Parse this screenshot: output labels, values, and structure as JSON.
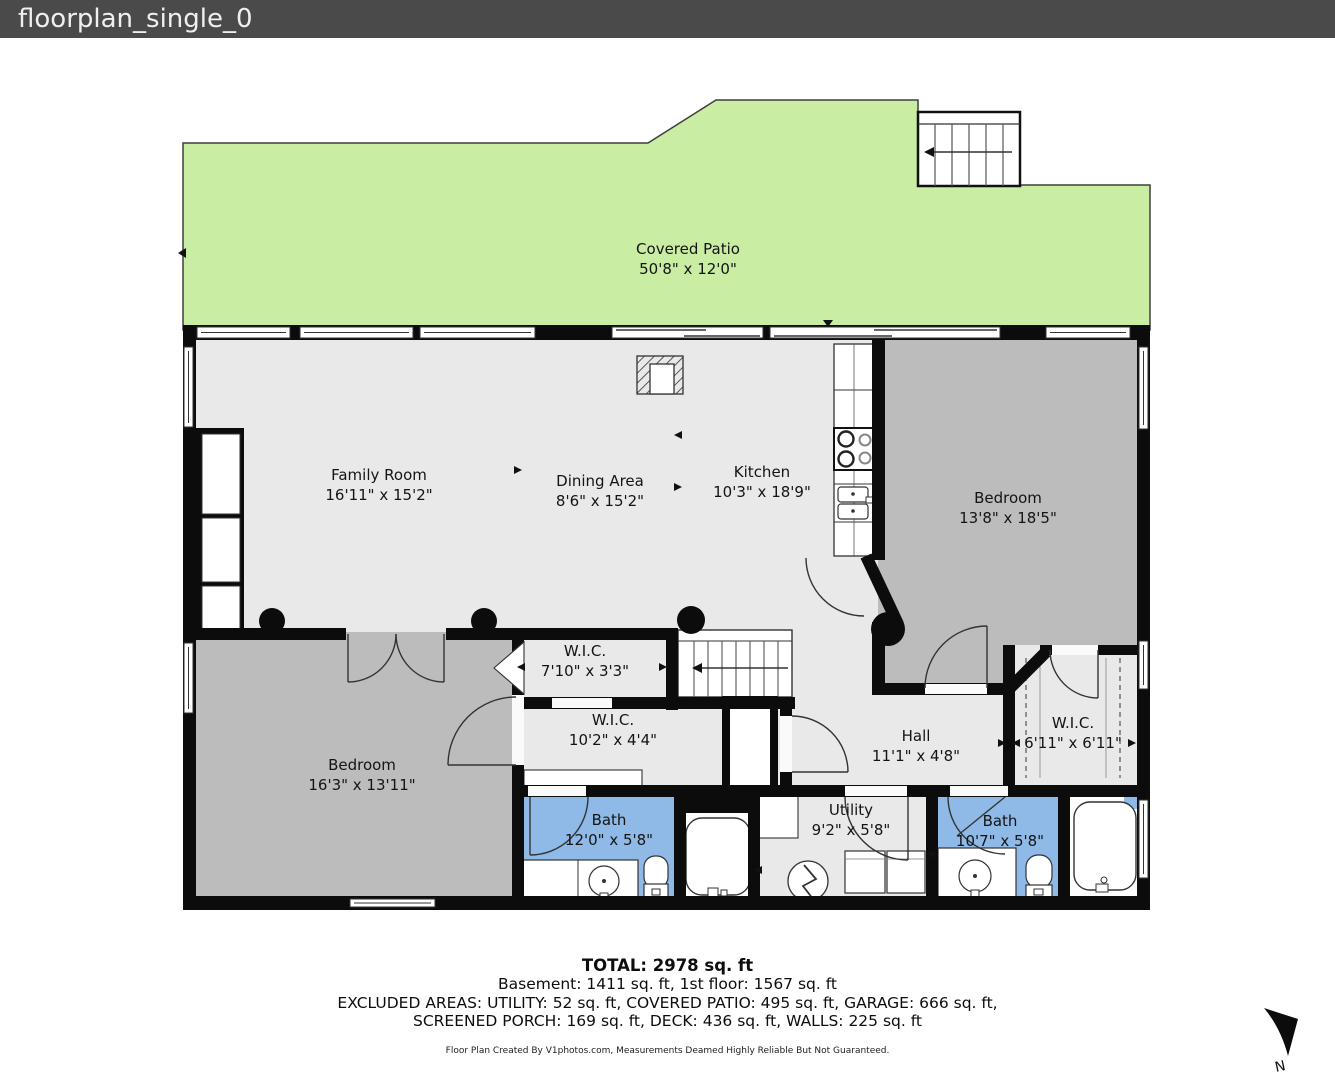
{
  "title_bar": {
    "title": "floorplan_single_0"
  },
  "rooms": [
    {
      "id": "covered-patio",
      "name": "Covered Patio",
      "dims": "50'8\" x 12'0\""
    },
    {
      "id": "family-room",
      "name": "Family Room",
      "dims": "16'11\" x 15'2\""
    },
    {
      "id": "dining-area",
      "name": "Dining Area",
      "dims": "8'6\" x 15'2\""
    },
    {
      "id": "kitchen",
      "name": "Kitchen",
      "dims": "10'3\" x 18'9\""
    },
    {
      "id": "bedroom-right",
      "name": "Bedroom",
      "dims": "13'8\" x 18'5\""
    },
    {
      "id": "wic-small",
      "name": "W.I.C.",
      "dims": "7'10\" x 3'3\""
    },
    {
      "id": "wic-mid",
      "name": "W.I.C.",
      "dims": "10'2\" x 4'4\""
    },
    {
      "id": "wic-right",
      "name": "W.I.C.",
      "dims": "6'11\" x 6'11\""
    },
    {
      "id": "hall",
      "name": "Hall",
      "dims": "11'1\" x 4'8\""
    },
    {
      "id": "bedroom-left",
      "name": "Bedroom",
      "dims": "16'3\" x 13'11\""
    },
    {
      "id": "bath-left",
      "name": "Bath",
      "dims": "12'0\" x 5'8\""
    },
    {
      "id": "utility",
      "name": "Utility",
      "dims": "9'2\" x 5'8\""
    },
    {
      "id": "bath-right",
      "name": "Bath",
      "dims": "10'7\" x 5'8\""
    }
  ],
  "summary": {
    "total": "TOTAL: 2978 sq. ft",
    "line2": "Basement: 1411 sq. ft, 1st floor: 1567 sq. ft",
    "line3": "EXCLUDED AREAS: UTILITY: 52 sq. ft, COVERED PATIO: 495 sq. ft, GARAGE: 666 sq. ft,",
    "line4": "SCREENED PORCH: 169 sq. ft, DECK: 436 sq. ft, WALLS: 225 sq. ft"
  },
  "footer": {
    "credit": "Floor Plan Created By V1photos.com, Measurements Deamed Highly Reliable But Not Guaranteed."
  },
  "compass": {
    "label": "N"
  },
  "colors": {
    "titlebar_bg": "#4a4a4a",
    "patio_green": "#c9eda2",
    "floor_gray": "#e9e9e9",
    "bedroom_gray": "#bcbcbc",
    "bath_blue": "#8fb9e6",
    "wall_black": "#0c0c0c"
  }
}
